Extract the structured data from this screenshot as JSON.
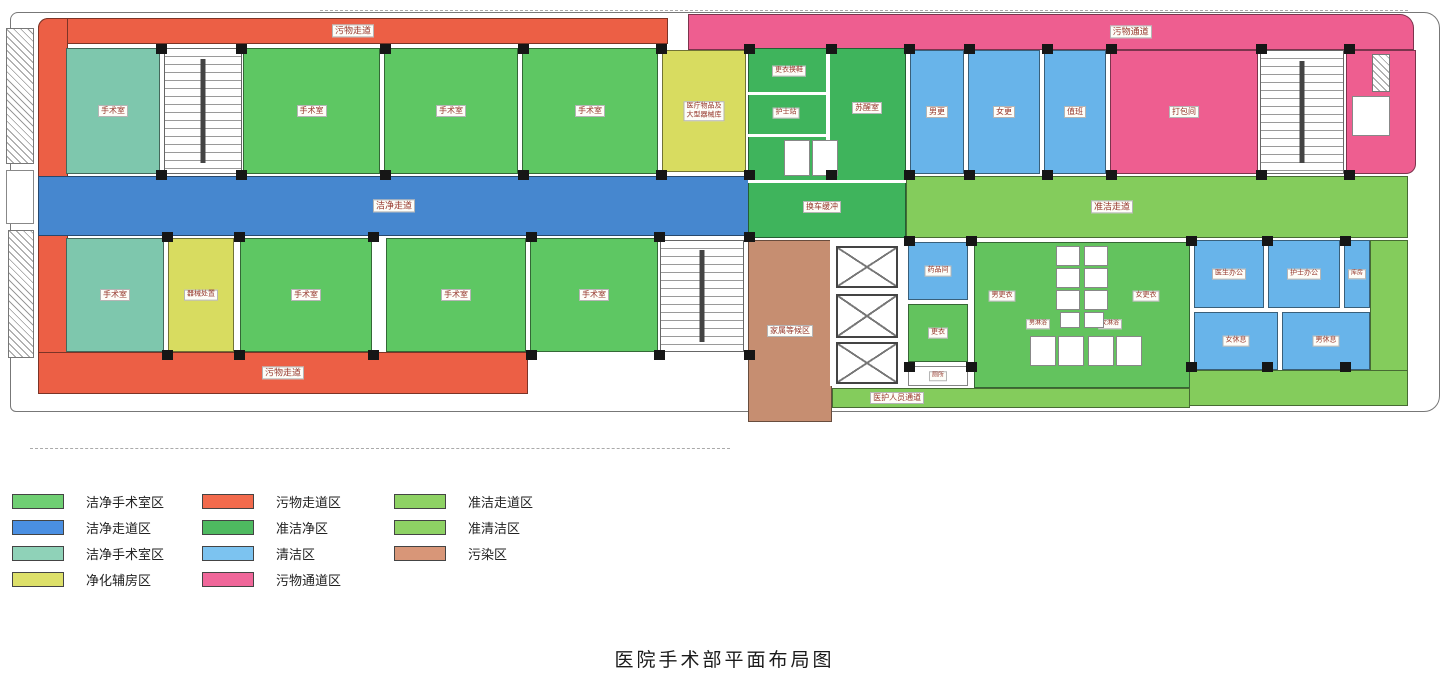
{
  "title": "医院手术部平面布局图",
  "legend": {
    "columns": [
      {
        "items": [
          {
            "label": "洁净手术室区",
            "color": "#6fcf73"
          },
          {
            "label": "洁净走道区",
            "color": "#4a8fe2"
          },
          {
            "label": "洁净手术室区",
            "color": "#8fd2b8"
          },
          {
            "label": "净化辅房区",
            "color": "#dde06a"
          }
        ]
      },
      {
        "items": [
          {
            "label": "污物走道区",
            "color": "#f26a4c"
          },
          {
            "label": "准洁净区",
            "color": "#4eba60"
          },
          {
            "label": "清洁区",
            "color": "#7cc3f0"
          },
          {
            "label": "污物通道区",
            "color": "#f0679a"
          }
        ]
      },
      {
        "items": [
          {
            "label": "准洁走道区",
            "color": "#8ed264"
          },
          {
            "label": "准清洁区",
            "color": "#8ed264"
          },
          {
            "label": "污染区",
            "color": "#d89678"
          }
        ]
      }
    ]
  },
  "plan": {
    "palette": {
      "orGreen": "#5ec763",
      "teal": "#7ec7ad",
      "yellow": "#d8dc60",
      "blueCorr": "#4687cf",
      "medGreen": "#3fb45c",
      "ltBlue": "#68b4ea",
      "pink": "#ee5e90",
      "ltGreen": "#84cc5c",
      "green2": "#63c35e",
      "orange": "#ec5f45",
      "brown": "#c68e71",
      "white": "#ffffff"
    },
    "rooms": [
      {
        "n": "corridor-dirty-top",
        "l": "污物走道",
        "f": "orange",
        "x": 38,
        "y": 18,
        "w": 630,
        "h": 26,
        "fs": 9,
        "br": "10px 0 0 0"
      },
      {
        "n": "corridor-dirty-left",
        "f": "orange",
        "x": 38,
        "y": 18,
        "w": 30,
        "h": 376,
        "br": "10px 0 0 6px"
      },
      {
        "n": "corridor-dirty-bottom",
        "l": "污物走道",
        "f": "orange",
        "x": 38,
        "y": 352,
        "w": 490,
        "h": 42,
        "fs": 9
      },
      {
        "n": "corridor-clean",
        "l": "洁净走道",
        "f": "blueCorr",
        "x": 38,
        "y": 176,
        "w": 712,
        "h": 60,
        "fs": 9
      },
      {
        "n": "corridor-waste",
        "l": "污物通道",
        "f": "pink",
        "x": 688,
        "y": 14,
        "w": 726,
        "h": 36,
        "fs": 9,
        "lx": "61%",
        "br": "0 14px 0 0"
      },
      {
        "n": "corridor-semiclean",
        "l": "准洁走道",
        "f": "ltGreen",
        "x": 906,
        "y": 176,
        "w": 502,
        "h": 62,
        "fs": 9,
        "lx": "41%"
      },
      {
        "n": "corridor-semiclean-right",
        "f": "ltGreen",
        "x": 1370,
        "y": 240,
        "w": 38,
        "h": 166,
        "br": "0 0 14px 0"
      },
      {
        "n": "corridor-semiclean-bottom",
        "f": "ltGreen",
        "x": 1186,
        "y": 370,
        "w": 222,
        "h": 36
      },
      {
        "n": "or-room-1",
        "l": "手术室",
        "f": "teal",
        "x": 66,
        "y": 48,
        "w": 94,
        "h": 126,
        "fs": 8
      },
      {
        "n": "or-room-2",
        "l": "手术室",
        "f": "orGreen",
        "x": 243,
        "y": 48,
        "w": 137,
        "h": 126,
        "fs": 8
      },
      {
        "n": "or-room-3",
        "l": "手术室",
        "f": "orGreen",
        "x": 384,
        "y": 48,
        "w": 134,
        "h": 126,
        "fs": 8
      },
      {
        "n": "or-room-4",
        "l": "手术室",
        "f": "orGreen",
        "x": 522,
        "y": 48,
        "w": 136,
        "h": 126,
        "fs": 8
      },
      {
        "n": "or-room-5",
        "l": "手术室",
        "f": "teal",
        "x": 66,
        "y": 238,
        "w": 98,
        "h": 114,
        "fs": 8
      },
      {
        "n": "aux-room",
        "l": "器械处置",
        "f": "yellow",
        "x": 168,
        "y": 238,
        "w": 66,
        "h": 114,
        "fs": 7
      },
      {
        "n": "or-room-6",
        "l": "手术室",
        "f": "orGreen",
        "x": 240,
        "y": 238,
        "w": 132,
        "h": 114,
        "fs": 8
      },
      {
        "n": "or-room-7",
        "l": "手术室",
        "f": "orGreen",
        "x": 386,
        "y": 238,
        "w": 140,
        "h": 114,
        "fs": 8
      },
      {
        "n": "or-room-8",
        "l": "手术室",
        "f": "orGreen",
        "x": 530,
        "y": 238,
        "w": 128,
        "h": 114,
        "fs": 8
      },
      {
        "n": "supply-room",
        "l": [
          "医疗物品及",
          "大型器械库"
        ],
        "f": "yellow",
        "x": 662,
        "y": 50,
        "w": 84,
        "h": 122,
        "fs": 7
      },
      {
        "n": "semiclean-block",
        "f": "medGreen",
        "x": 748,
        "y": 48,
        "w": 158,
        "h": 190
      },
      {
        "n": "staff-room-1",
        "l": "男更",
        "f": "ltBlue",
        "x": 910,
        "y": 50,
        "w": 54,
        "h": 124,
        "fs": 8
      },
      {
        "n": "staff-room-2",
        "l": "女更",
        "f": "ltBlue",
        "x": 968,
        "y": 50,
        "w": 72,
        "h": 124,
        "fs": 8
      },
      {
        "n": "staff-room-3",
        "l": "值班",
        "f": "ltBlue",
        "x": 1044,
        "y": 50,
        "w": 62,
        "h": 124,
        "fs": 8
      },
      {
        "n": "packing-room",
        "l": "打包间",
        "f": "pink",
        "x": 1110,
        "y": 50,
        "w": 148,
        "h": 124,
        "fs": 8
      },
      {
        "n": "waste-rooms-east",
        "f": "pink",
        "x": 1346,
        "y": 50,
        "w": 70,
        "h": 124,
        "br": "0 0 10px 0"
      },
      {
        "n": "pharmacy-room",
        "l": "药品间",
        "f": "ltBlue",
        "x": 908,
        "y": 242,
        "w": 60,
        "h": 58,
        "fs": 7
      },
      {
        "n": "changing-room-small",
        "l": "更衣",
        "f": "green2",
        "x": 908,
        "y": 304,
        "w": 60,
        "h": 58,
        "fs": 7
      },
      {
        "n": "wc-room",
        "l": "厕所",
        "f": "white",
        "x": 908,
        "y": 366,
        "w": 60,
        "h": 20,
        "fs": 6
      },
      {
        "n": "changing-block",
        "f": "green2",
        "x": 974,
        "y": 242,
        "w": 216,
        "h": 146
      },
      {
        "n": "doctor-office",
        "l": "医生办公",
        "f": "ltBlue",
        "x": 1194,
        "y": 240,
        "w": 70,
        "h": 68,
        "fs": 7
      },
      {
        "n": "nurse-office",
        "l": "护士办公",
        "f": "ltBlue",
        "x": 1268,
        "y": 240,
        "w": 72,
        "h": 68,
        "fs": 7
      },
      {
        "n": "storage-room",
        "l": "库房",
        "f": "ltBlue",
        "x": 1344,
        "y": 240,
        "w": 26,
        "h": 68,
        "fs": 6
      },
      {
        "n": "female-rest-room",
        "l": "女休息",
        "f": "ltBlue",
        "x": 1194,
        "y": 312,
        "w": 84,
        "h": 58,
        "fs": 7
      },
      {
        "n": "male-rest-room",
        "l": "男休息",
        "f": "ltBlue",
        "x": 1282,
        "y": 312,
        "w": 88,
        "h": 58,
        "fs": 7
      },
      {
        "n": "family-waiting",
        "l": "家属等候区",
        "f": "brown",
        "x": 748,
        "y": 240,
        "w": 84,
        "h": 182,
        "fs": 8
      },
      {
        "n": "corridor-staff",
        "l": "医护人员通道",
        "f": "ltGreen",
        "x": 832,
        "y": 388,
        "w": 358,
        "h": 20,
        "fs": 8,
        "lx": "18%"
      },
      {
        "n": "label-change-shoes",
        "l": "更衣换鞋",
        "f": "none",
        "x": 789,
        "y": 71,
        "w": 0,
        "h": 0,
        "fs": 7
      },
      {
        "n": "label-nurse-station",
        "l": "护士站",
        "f": "none",
        "x": 786,
        "y": 113,
        "w": 0,
        "h": 0,
        "fs": 7
      },
      {
        "n": "label-cabinet",
        "l": "柜",
        "f": "none",
        "x": 800,
        "y": 158,
        "w": 0,
        "h": 0,
        "fs": 6
      },
      {
        "n": "label-recovery",
        "l": "苏醒室",
        "f": "none",
        "x": 867,
        "y": 108,
        "w": 0,
        "h": 0,
        "fs": 8
      },
      {
        "n": "label-bed-exchange",
        "l": "换车缓冲",
        "f": "none",
        "x": 822,
        "y": 207,
        "w": 0,
        "h": 0,
        "fs": 8
      },
      {
        "n": "label-male-changing",
        "l": "男更衣",
        "f": "none",
        "x": 1002,
        "y": 296,
        "w": 0,
        "h": 0,
        "fs": 7
      },
      {
        "n": "label-female-changing",
        "l": "女更衣",
        "f": "none",
        "x": 1146,
        "y": 296,
        "w": 0,
        "h": 0,
        "fs": 7
      },
      {
        "n": "label-male-shower",
        "l": "男淋浴",
        "f": "none",
        "x": 1038,
        "y": 324,
        "w": 0,
        "h": 0,
        "fs": 6
      },
      {
        "n": "label-female-shower",
        "l": "女淋浴",
        "f": "none",
        "x": 1110,
        "y": 324,
        "w": 0,
        "h": 0,
        "fs": 6
      }
    ],
    "features": [
      {
        "t": "stairs",
        "x": 164,
        "y": 48,
        "w": 78,
        "h": 126
      },
      {
        "t": "stairs",
        "x": 660,
        "y": 240,
        "w": 84,
        "h": 112
      },
      {
        "t": "stairs",
        "x": 1260,
        "y": 50,
        "w": 84,
        "h": 124
      },
      {
        "t": "wline",
        "x": 830,
        "y": 240,
        "w": 78,
        "h": 146
      },
      {
        "t": "elevator",
        "x": 836,
        "y": 246,
        "w": 62,
        "h": 42
      },
      {
        "t": "elevator",
        "x": 836,
        "y": 294,
        "w": 62,
        "h": 44
      },
      {
        "t": "elevator",
        "x": 836,
        "y": 342,
        "w": 62,
        "h": 42
      },
      {
        "t": "wline",
        "x": 826,
        "y": 48,
        "w": 4,
        "h": 132
      },
      {
        "t": "wline",
        "x": 748,
        "y": 92,
        "w": 80,
        "h": 3
      },
      {
        "t": "wline",
        "x": 748,
        "y": 134,
        "w": 80,
        "h": 3
      },
      {
        "t": "wline",
        "x": 748,
        "y": 180,
        "w": 158,
        "h": 3
      },
      {
        "t": "cell",
        "x": 784,
        "y": 140,
        "w": 26,
        "h": 36
      },
      {
        "t": "cell",
        "x": 812,
        "y": 140,
        "w": 26,
        "h": 36
      },
      {
        "t": "cell",
        "x": 1352,
        "y": 96,
        "w": 38,
        "h": 40
      },
      {
        "t": "cell",
        "x": 6,
        "y": 170,
        "w": 28,
        "h": 54
      },
      {
        "t": "cell",
        "x": 1056,
        "y": 246,
        "w": 24,
        "h": 20
      },
      {
        "t": "cell",
        "x": 1056,
        "y": 268,
        "w": 24,
        "h": 20
      },
      {
        "t": "cell",
        "x": 1056,
        "y": 290,
        "w": 24,
        "h": 20
      },
      {
        "t": "cell",
        "x": 1084,
        "y": 246,
        "w": 24,
        "h": 20
      },
      {
        "t": "cell",
        "x": 1084,
        "y": 268,
        "w": 24,
        "h": 20
      },
      {
        "t": "cell",
        "x": 1084,
        "y": 290,
        "w": 24,
        "h": 20
      },
      {
        "t": "cell",
        "x": 1030,
        "y": 336,
        "w": 26,
        "h": 30
      },
      {
        "t": "cell",
        "x": 1058,
        "y": 336,
        "w": 26,
        "h": 30
      },
      {
        "t": "cell",
        "x": 1088,
        "y": 336,
        "w": 26,
        "h": 30
      },
      {
        "t": "cell",
        "x": 1116,
        "y": 336,
        "w": 26,
        "h": 30
      },
      {
        "t": "cell",
        "x": 1060,
        "y": 312,
        "w": 20,
        "h": 16
      },
      {
        "t": "cell",
        "x": 1084,
        "y": 312,
        "w": 20,
        "h": 16
      },
      {
        "t": "hatch",
        "x": 6,
        "y": 28,
        "w": 28,
        "h": 136
      },
      {
        "t": "hatch",
        "x": 8,
        "y": 230,
        "w": 26,
        "h": 128
      },
      {
        "t": "hatch",
        "x": 1372,
        "y": 54,
        "w": 18,
        "h": 38
      },
      {
        "t": "tick",
        "x": 320,
        "y": 10,
        "w": 1088,
        "h": 0
      },
      {
        "t": "tick",
        "x": 30,
        "y": 448,
        "w": 700,
        "h": 0
      }
    ],
    "columns": [
      [
        156,
        44
      ],
      [
        236,
        44
      ],
      [
        380,
        44
      ],
      [
        518,
        44
      ],
      [
        656,
        44
      ],
      [
        744,
        44
      ],
      [
        826,
        44
      ],
      [
        904,
        44
      ],
      [
        964,
        44
      ],
      [
        1042,
        44
      ],
      [
        1106,
        44
      ],
      [
        1256,
        44
      ],
      [
        1344,
        44
      ],
      [
        156,
        170
      ],
      [
        236,
        170
      ],
      [
        380,
        170
      ],
      [
        518,
        170
      ],
      [
        656,
        170
      ],
      [
        744,
        170
      ],
      [
        826,
        170
      ],
      [
        904,
        170
      ],
      [
        964,
        170
      ],
      [
        1042,
        170
      ],
      [
        1106,
        170
      ],
      [
        1256,
        170
      ],
      [
        1344,
        170
      ],
      [
        162,
        232
      ],
      [
        234,
        232
      ],
      [
        368,
        232
      ],
      [
        526,
        232
      ],
      [
        654,
        232
      ],
      [
        744,
        232
      ],
      [
        162,
        350
      ],
      [
        234,
        350
      ],
      [
        368,
        350
      ],
      [
        526,
        350
      ],
      [
        654,
        350
      ],
      [
        744,
        350
      ],
      [
        904,
        236
      ],
      [
        966,
        236
      ],
      [
        1186,
        236
      ],
      [
        1262,
        236
      ],
      [
        1340,
        236
      ],
      [
        904,
        362
      ],
      [
        966,
        362
      ],
      [
        1186,
        362
      ],
      [
        1262,
        362
      ],
      [
        1340,
        362
      ]
    ]
  }
}
